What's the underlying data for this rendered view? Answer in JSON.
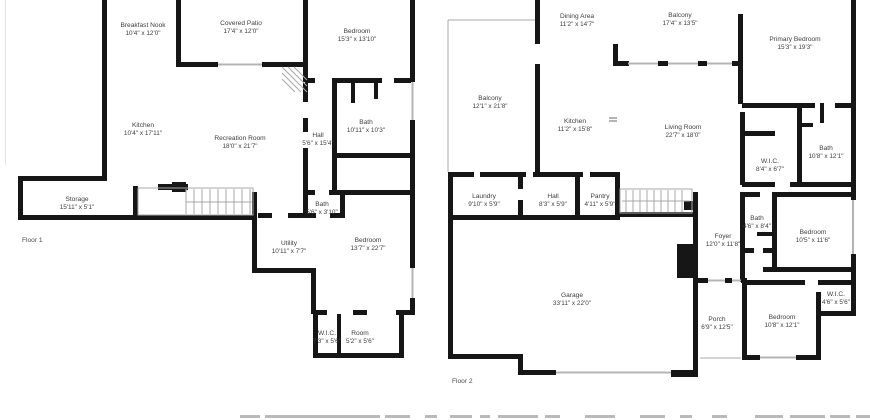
{
  "colors": {
    "background": "#ffffff",
    "wall": "#161616",
    "thin_line": "#a8a8a8",
    "label_text": "#3d3d3d"
  },
  "floors": [
    {
      "label": "Floor 1",
      "rooms": [
        {
          "name": "Breakfast Nook",
          "dims": "10'4\" x 12'0\""
        },
        {
          "name": "Covered Patio",
          "dims": "17'4\" x 12'0\""
        },
        {
          "name": "Bedroom",
          "dims": "15'3\" x 13'10\""
        },
        {
          "name": "Kitchen",
          "dims": "10'4\" x 17'11\""
        },
        {
          "name": "Recreation Room",
          "dims": "18'0\" x 21'7\""
        },
        {
          "name": "Hall",
          "dims": "5'6\" x 15'4\""
        },
        {
          "name": "Bath",
          "dims": "10'11\" x 10'3\""
        },
        {
          "name": "Storage",
          "dims": "15'11\" x 5'1\""
        },
        {
          "name": "Bath",
          "dims": "5'6\" x 3'10\""
        },
        {
          "name": "Utility",
          "dims": "10'11\" x 7'7\""
        },
        {
          "name": "Bedroom",
          "dims": "13'7\" x 22'7\""
        },
        {
          "name": "W.I.C.",
          "dims": "7'3\" x 5'6\""
        },
        {
          "name": "Room",
          "dims": "5'2\" x 5'6\""
        }
      ]
    },
    {
      "label": "Floor 2",
      "rooms": [
        {
          "name": "Dining Area",
          "dims": "11'2\" x 14'7\""
        },
        {
          "name": "Balcony",
          "dims": "17'4\" x 13'5\""
        },
        {
          "name": "Primary Bedroom",
          "dims": "15'3\" x 19'3\""
        },
        {
          "name": "Balcony",
          "dims": "12'1\" x 21'8\""
        },
        {
          "name": "Kitchen",
          "dims": "11'2\" x 15'8\""
        },
        {
          "name": "Living Room",
          "dims": "22'7\" x 18'0\""
        },
        {
          "name": "W.I.C.",
          "dims": "8'4\" x 6'7\""
        },
        {
          "name": "Bath",
          "dims": "10'8\" x 12'1\""
        },
        {
          "name": "Laundry",
          "dims": "9'10\" x 5'9\""
        },
        {
          "name": "Hall",
          "dims": "8'3\" x 5'9\""
        },
        {
          "name": "Pantry",
          "dims": "4'11\" x 5'9\""
        },
        {
          "name": "Bath",
          "dims": "4'6\" x 8'4\""
        },
        {
          "name": "Foyer",
          "dims": "12'0\" x 11'8\""
        },
        {
          "name": "Bedroom",
          "dims": "10'5\" x 11'6\""
        },
        {
          "name": "Garage",
          "dims": "33'11\" x 22'0\""
        },
        {
          "name": "Porch",
          "dims": "6'9\" x 12'5\""
        },
        {
          "name": "Bedroom",
          "dims": "10'8\" x 12'1\""
        },
        {
          "name": "W.I.C.",
          "dims": "4'6\" x 5'6\""
        }
      ]
    }
  ]
}
